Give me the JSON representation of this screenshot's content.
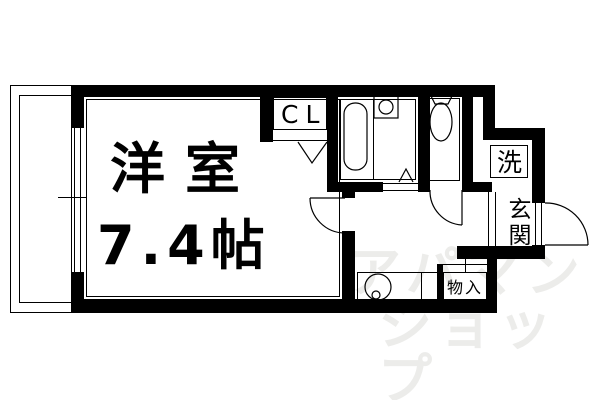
{
  "floorplan": {
    "room": {
      "name": "洋室",
      "size": "7.4帖"
    },
    "closet": {
      "label": "CL"
    },
    "laundry": {
      "label": "洗"
    },
    "entrance": {
      "label": "玄関"
    },
    "storage": {
      "label": "物入"
    },
    "colors": {
      "wall": "#000000",
      "background": "#ffffff",
      "watermark": "#ececea"
    },
    "watermark": {
      "line1": "アパマン",
      "line2": "ショップ",
      "brand": "アパマンショップ"
    }
  }
}
